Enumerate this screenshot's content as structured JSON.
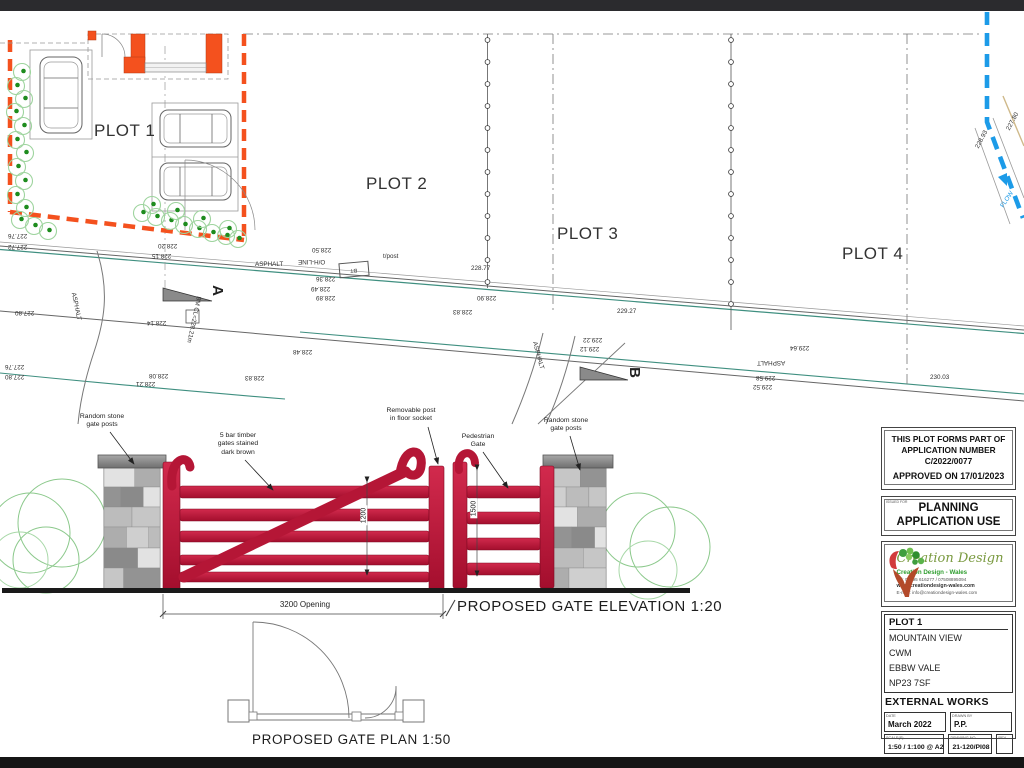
{
  "plan": {
    "plot_labels": [
      {
        "text": "PLOT 1",
        "x": 94,
        "y": 121
      },
      {
        "text": "PLOT 2",
        "x": 366,
        "y": 174
      },
      {
        "text": "PLOT 3",
        "x": 557,
        "y": 224
      },
      {
        "text": "PLOT 4",
        "x": 842,
        "y": 244
      }
    ],
    "section_markers": [
      {
        "label": "A",
        "x": 212,
        "y": 282
      },
      {
        "label": "B",
        "x": 629,
        "y": 364
      }
    ],
    "bt_label": "BT",
    "survey_labels": [
      {
        "text": "227.76",
        "x": 8,
        "y": 232,
        "rot": 180
      },
      {
        "text": "227.72",
        "x": 8,
        "y": 243,
        "rot": 180
      },
      {
        "text": "228.20",
        "x": 158,
        "y": 242,
        "rot": 180
      },
      {
        "text": "228.15",
        "x": 152,
        "y": 252,
        "rot": 180
      },
      {
        "text": "ASPHALT",
        "x": 255,
        "y": 261,
        "rot": 0
      },
      {
        "text": "O/H-LINE",
        "x": 298,
        "y": 258,
        "rot": 180
      },
      {
        "text": "228.50",
        "x": 312,
        "y": 246,
        "rot": 180
      },
      {
        "text": "228.36",
        "x": 316,
        "y": 275,
        "rot": 180
      },
      {
        "text": "228.49",
        "x": 311,
        "y": 285,
        "rot": 180
      },
      {
        "text": "228.89",
        "x": 316,
        "y": 294,
        "rot": 180
      },
      {
        "text": "227.80",
        "x": 15,
        "y": 309,
        "rot": 180
      },
      {
        "text": "228.14",
        "x": 147,
        "y": 319,
        "rot": 180
      },
      {
        "text": "BM CL=228.21m",
        "x": 170,
        "y": 316,
        "rot": 102
      },
      {
        "text": "ASPHALT",
        "x": 62,
        "y": 303,
        "rot": 78
      },
      {
        "text": "227.76",
        "x": 5,
        "y": 363,
        "rot": 180
      },
      {
        "text": "227.80",
        "x": 5,
        "y": 373,
        "rot": 180
      },
      {
        "text": "228.08",
        "x": 149,
        "y": 372,
        "rot": 180
      },
      {
        "text": "228.21",
        "x": 136,
        "y": 380,
        "rot": 180
      },
      {
        "text": "228.48",
        "x": 293,
        "y": 348,
        "rot": 180
      },
      {
        "text": "228.83",
        "x": 245,
        "y": 374,
        "rot": 180
      },
      {
        "text": "228.83",
        "x": 453,
        "y": 308,
        "rot": 180
      },
      {
        "text": "228.77",
        "x": 471,
        "y": 265,
        "rot": 0
      },
      {
        "text": "228.90",
        "x": 477,
        "y": 294,
        "rot": 180
      },
      {
        "text": "t/post",
        "x": 383,
        "y": 253,
        "rot": 0
      },
      {
        "text": "229.27",
        "x": 617,
        "y": 308,
        "rot": 0
      },
      {
        "text": "229.22",
        "x": 583,
        "y": 336,
        "rot": 180
      },
      {
        "text": "229.12",
        "x": 580,
        "y": 345,
        "rot": 180
      },
      {
        "text": "229.64",
        "x": 790,
        "y": 344,
        "rot": 180
      },
      {
        "text": "ASPHALT",
        "x": 757,
        "y": 359,
        "rot": 180
      },
      {
        "text": "229.58",
        "x": 756,
        "y": 374,
        "rot": 180
      },
      {
        "text": "229.52",
        "x": 753,
        "y": 383,
        "rot": 180
      },
      {
        "text": "230.03",
        "x": 930,
        "y": 374,
        "rot": 0
      },
      {
        "text": "ASPHALT",
        "x": 524,
        "y": 352,
        "rot": 75
      },
      {
        "text": "227.80",
        "x": 1003,
        "y": 118,
        "rot": -62
      },
      {
        "text": "228.93",
        "x": 972,
        "y": 136,
        "rot": -62
      },
      {
        "text": "FLOW",
        "x": 998,
        "y": 196,
        "rot": -56,
        "color": "#1c9be8"
      }
    ]
  },
  "elevation": {
    "title": "PROPOSED GATE ELEVATION  1:20",
    "annotations": [
      {
        "text": "Random stone\ngate posts",
        "x": 66,
        "y": 413,
        "w": 72
      },
      {
        "text": "5 bar timber\ngates stained\ndark brown",
        "x": 200,
        "y": 432,
        "w": 76
      },
      {
        "text": "Removable post\nin floor socket",
        "x": 368,
        "y": 407,
        "w": 86
      },
      {
        "text": "Pedestrian\nGate",
        "x": 448,
        "y": 433,
        "w": 60
      },
      {
        "text": "Random stone\ngate posts",
        "x": 530,
        "y": 417,
        "w": 72
      }
    ],
    "dimensions": {
      "opening": "3200 Opening",
      "main_height": "1200",
      "ped_height": "1500"
    }
  },
  "gate_plan": {
    "title": "PROPOSED GATE PLAN  1:50"
  },
  "title_block": {
    "approval": {
      "line1": "THIS PLOT FORMS PART OF",
      "line2": "APPLICATION NUMBER",
      "line3": "C/2022/0077",
      "line4": "APPROVED ON 17/01/2023"
    },
    "stamp": {
      "small": "ISSUED FOR",
      "line1": "PLANNING",
      "line2": "APPLICATION USE"
    },
    "logo": {
      "script": "Creation Design",
      "name": "Creation Design - Wales",
      "tel": "Tel: 01495 616277 / 07508895094",
      "web": "www.creationdesign-wales.com",
      "email": "E-mail: info@creationdesign-wales.com"
    },
    "project": {
      "plot": "PLOT 1",
      "address": [
        "MOUNTAIN VIEW",
        "CWM",
        "EBBW VALE",
        "NP23 7SF"
      ]
    },
    "work_type": "EXTERNAL WORKS",
    "fields": [
      {
        "label": "DATE",
        "value": "March 2022"
      },
      {
        "label": "DRAWN BY",
        "value": "P.P."
      },
      {
        "label": "SCALE(S)",
        "value": "1:50 / 1:100 @ A2"
      },
      {
        "label": "DRAWING NO",
        "value": "21-120/PI08"
      },
      {
        "label": "REV",
        "value": ""
      }
    ]
  },
  "colors": {
    "boundary_orange": "#f4511e",
    "gate_red": "#c01834",
    "stream_blue": "#1c9be8",
    "kerb_teal": "#3f8f80",
    "logo_green": "#2f9e2f"
  }
}
